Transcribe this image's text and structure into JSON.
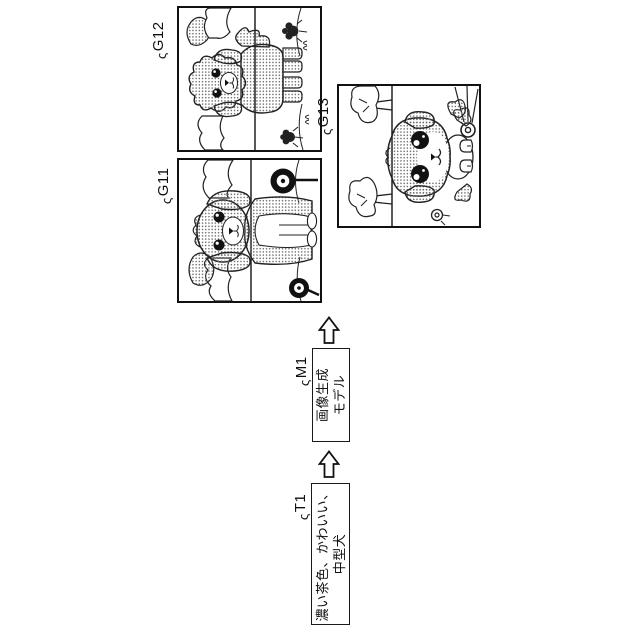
{
  "figure": {
    "leader_glyph": "ς",
    "prompt_box": {
      "label": "T1",
      "line1": "濃い茶色、かわいい、",
      "line2": "中型犬"
    },
    "model_box": {
      "label": "M1",
      "line1": "画像生成",
      "line2": "モデル"
    },
    "images": {
      "g11": {
        "label": "G11"
      },
      "g12": {
        "label": "G12"
      },
      "g13": {
        "label": "G13"
      }
    },
    "colors": {
      "ink": "#1a1a1a",
      "background": "#ffffff"
    }
  }
}
